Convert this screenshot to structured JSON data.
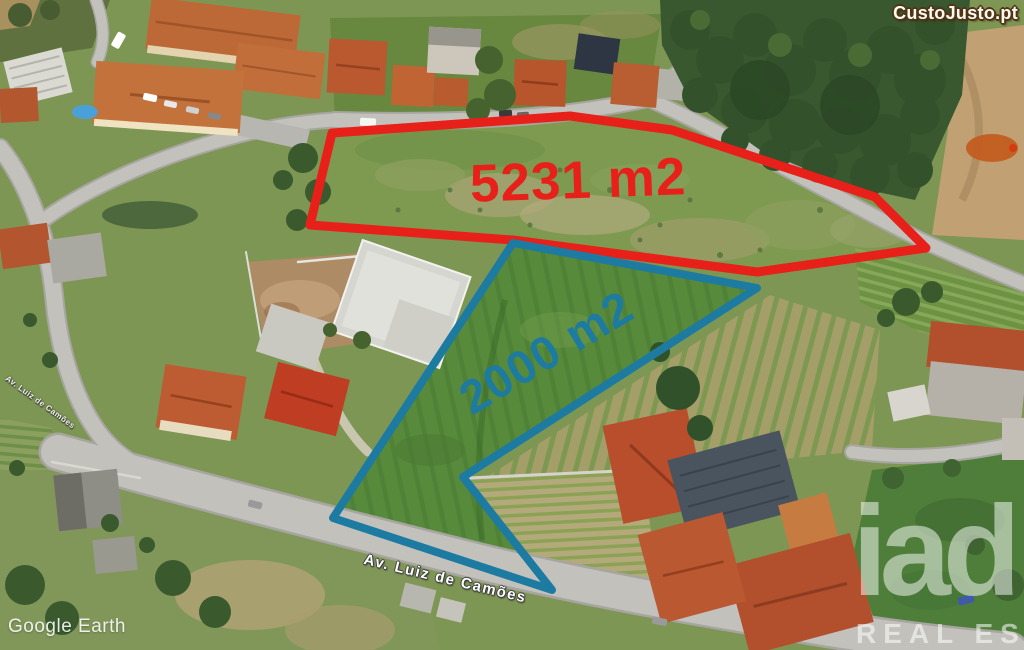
{
  "watermark": {
    "site": "CustoJusto.pt"
  },
  "parcels": {
    "large": {
      "area_label": "5231 m2",
      "outline_color": "#e8201a"
    },
    "small": {
      "area_label": "2000 m2",
      "outline_color": "#1d7ba2"
    }
  },
  "streets": {
    "main_label": "Av. Luiz de Camões",
    "secondary_label": "Av. Luiz de Camões"
  },
  "credits": {
    "imagery": "Google Earth"
  },
  "agency": {
    "name": "iad",
    "tagline": "REAL ESTATE"
  }
}
